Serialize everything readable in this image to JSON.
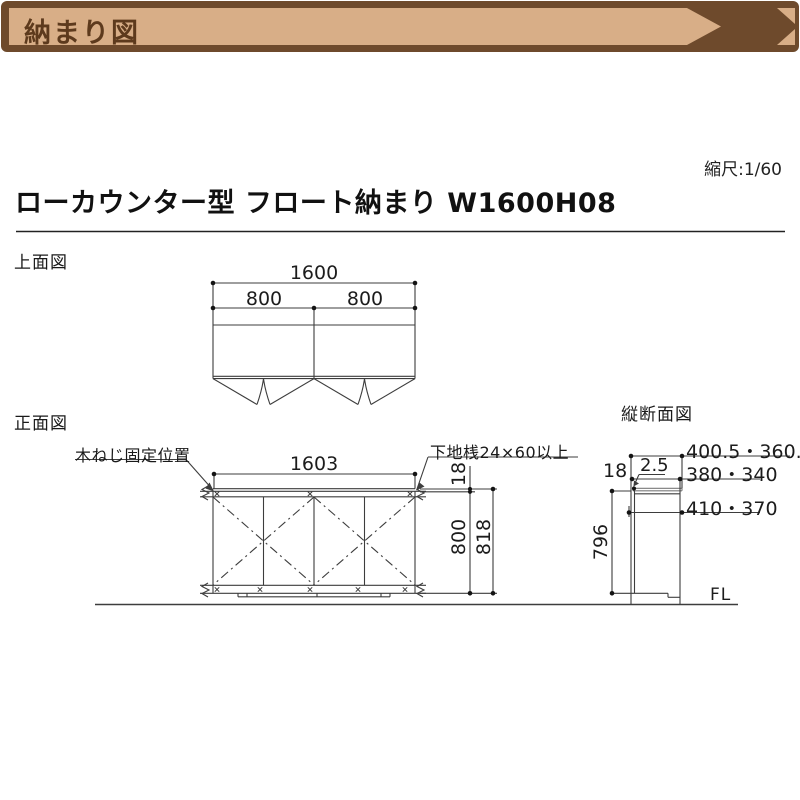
{
  "banner": {
    "title": "納まり図",
    "bg_color": "#6e4a2c",
    "bar_color": "#d8ae87",
    "text_color": "#5d3a1d"
  },
  "header": {
    "scale_label": "縮尺:1/60",
    "title": "ローカウンター型 フロート納まり W1600H08"
  },
  "top_view": {
    "label": "上面図",
    "dim_total_width": "1600",
    "dim_left_half": "800",
    "dim_right_half": "800"
  },
  "front_view": {
    "label": "正面図",
    "callout_screw": "木ねじ固定位置",
    "callout_rail": "下地桟24×60以上",
    "dim_width": "1603",
    "dim_top_thickness": "18",
    "dim_body_height": "800",
    "dim_total_height": "818"
  },
  "section_view": {
    "label": "縦断面図",
    "dim_depth_top": "400.5・360.5",
    "dim_depth_mid": "380・340",
    "dim_depth_bottom": "410・370",
    "dim_top_thickness": "18",
    "dim_front_gap": "2.5",
    "dim_height": "796",
    "floor_label": "FL"
  }
}
